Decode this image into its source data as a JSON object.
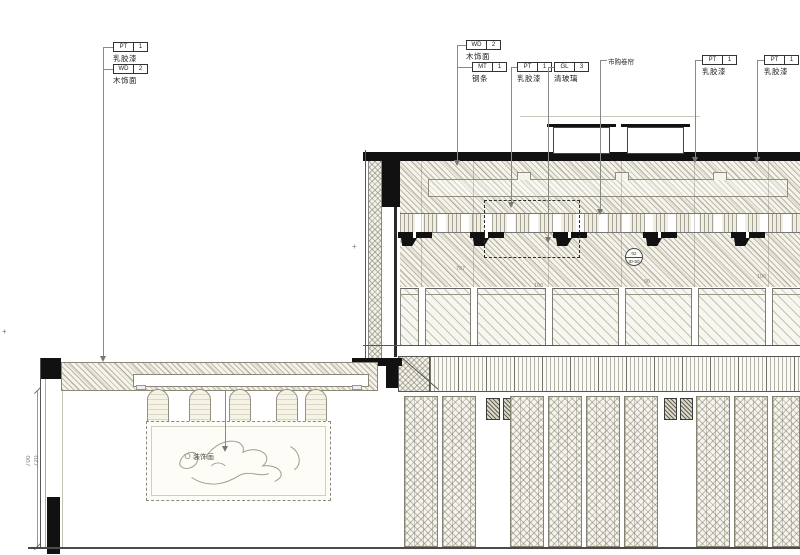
{
  "drawing": {
    "type": "interior-elevation-cad-drawing",
    "art_label": "装饰画"
  },
  "callouts": {
    "left": [
      {
        "code": "PT",
        "num": "1",
        "name": "乳胶漆"
      },
      {
        "code": "WD",
        "num": "2",
        "name": "木饰面"
      }
    ],
    "mid": [
      {
        "code": "WD",
        "num": "2",
        "name": "木饰面"
      },
      {
        "code": "MT",
        "num": "1",
        "name": "钢条"
      },
      {
        "code": "PT",
        "num": "1",
        "name": "乳胶漆"
      },
      {
        "code": "GL",
        "num": "3",
        "name": "清玻璃"
      }
    ],
    "note": "市购卷帘",
    "right": [
      {
        "code": "PT",
        "num": "1",
        "name": "乳胶漆"
      },
      {
        "code": "PT",
        "num": "1",
        "name": "乳胶漆"
      }
    ]
  },
  "detail_marker": {
    "top": "02",
    "bottom": "ID-50"
  },
  "dims": {
    "vertical": [
      "700",
      "720"
    ],
    "inline": [
      "787",
      "100",
      "90",
      "100"
    ]
  },
  "colors": {
    "line": "#4a4a4a",
    "hatch": "#a39f8e",
    "black_fill": "#111111",
    "paper": "#ffffff"
  }
}
